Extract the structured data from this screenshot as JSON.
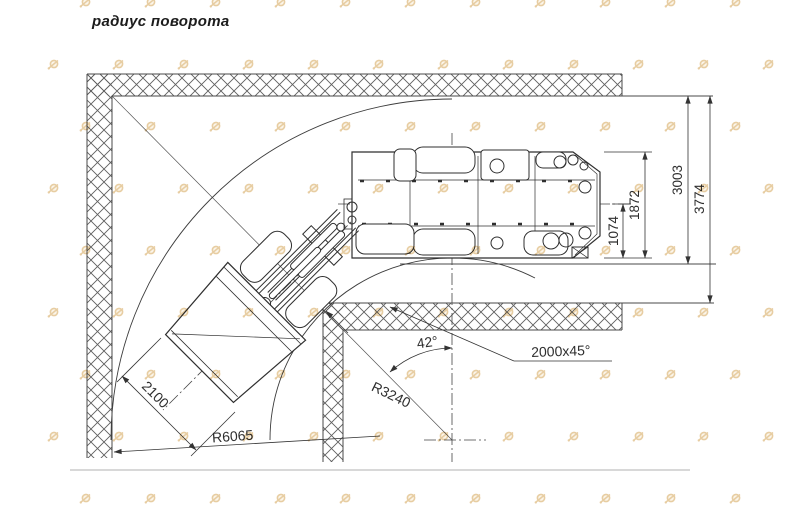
{
  "page": {
    "title": "радиус поворота"
  },
  "drawing": {
    "subject": "articulated-underground-loader-turning-radius-plan",
    "annotations": {
      "outer_radius": "R6065",
      "inner_radius": "R3240",
      "articulation_angle": "42°",
      "corner_chamfer": "2000x45°",
      "bucket_width": "2100"
    },
    "right_dimensions": {
      "half_width": "1074",
      "machine_width": "1872",
      "drift_clear_width": "3003",
      "drift_total_width": "3774"
    },
    "colors": {
      "line": "#3c3c3c",
      "hatch": "#5f5f5f",
      "watermark": "#cf9a43",
      "separator": "#d8d8d8"
    }
  }
}
